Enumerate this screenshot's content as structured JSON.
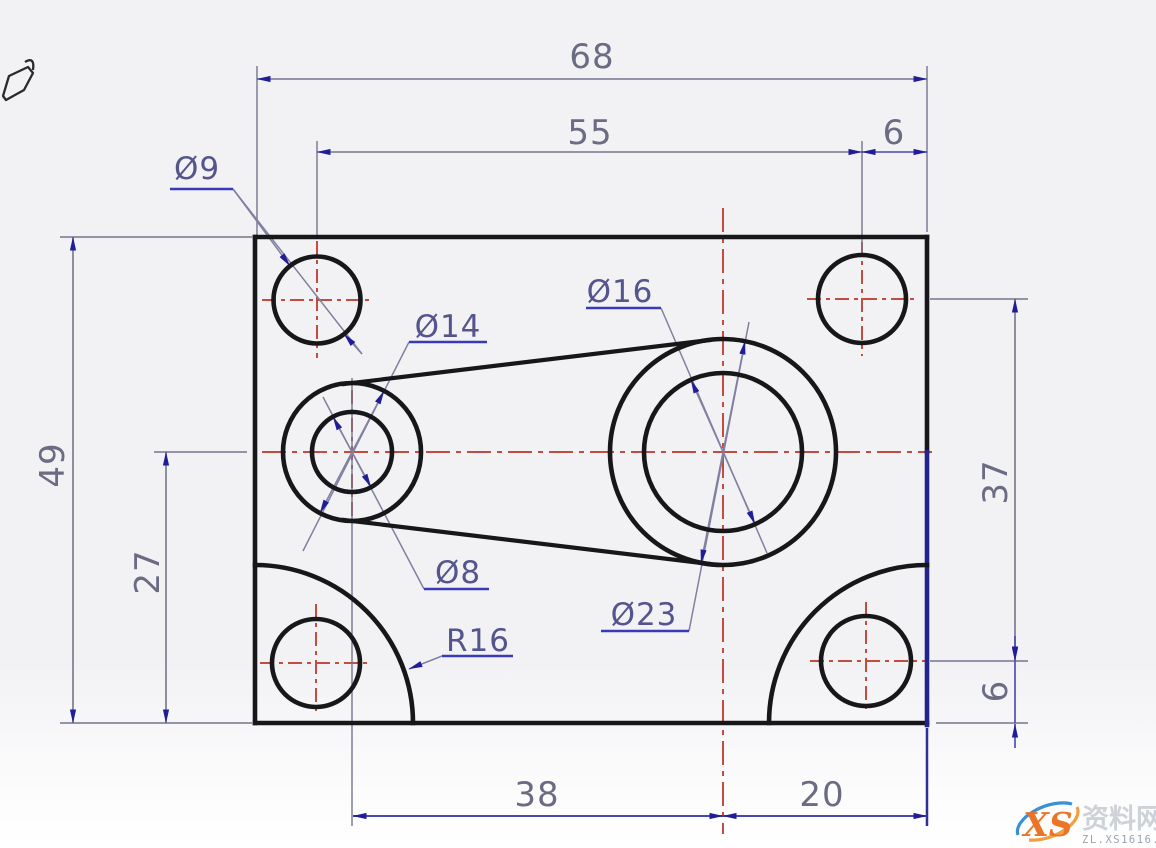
{
  "drawing_title": "dimensioned-plate-cad-drawing",
  "icons": {
    "top_left": "hand-cursor-icon",
    "watermark": "xs-swoosh-logo"
  },
  "dimensions": {
    "top": {
      "total_width": "68",
      "hole_span": "55",
      "right_offset": "6"
    },
    "left": {
      "total_height": "49",
      "boss_height": "27"
    },
    "right": {
      "hole_span": "37",
      "bottom_offset": "6"
    },
    "bottom": {
      "boss_span": "38",
      "right_span": "20"
    }
  },
  "callouts": {
    "corner_hole": "Ø9",
    "left_boss_outer": "Ø14",
    "left_boss_bore": "Ø8",
    "center_boss_bore": "Ø16",
    "center_boss_outer": "Ø23",
    "corner_fillet": "R16"
  },
  "colors": {
    "outline": "#17171a",
    "outline_highlight": "#23238c",
    "centerline_red": "#c24b42",
    "dimension_line": "#75758e",
    "dimension_line_blue": "#4646ae",
    "arrow": "#201d96",
    "dimension_text": "#6b6b84",
    "callout_text": "#55558e",
    "leader_underline": "#3a3ab8"
  },
  "watermark": {
    "logo_text": "XS",
    "site_name": "资料网",
    "site_url": "ZL.XS1616.COM"
  }
}
